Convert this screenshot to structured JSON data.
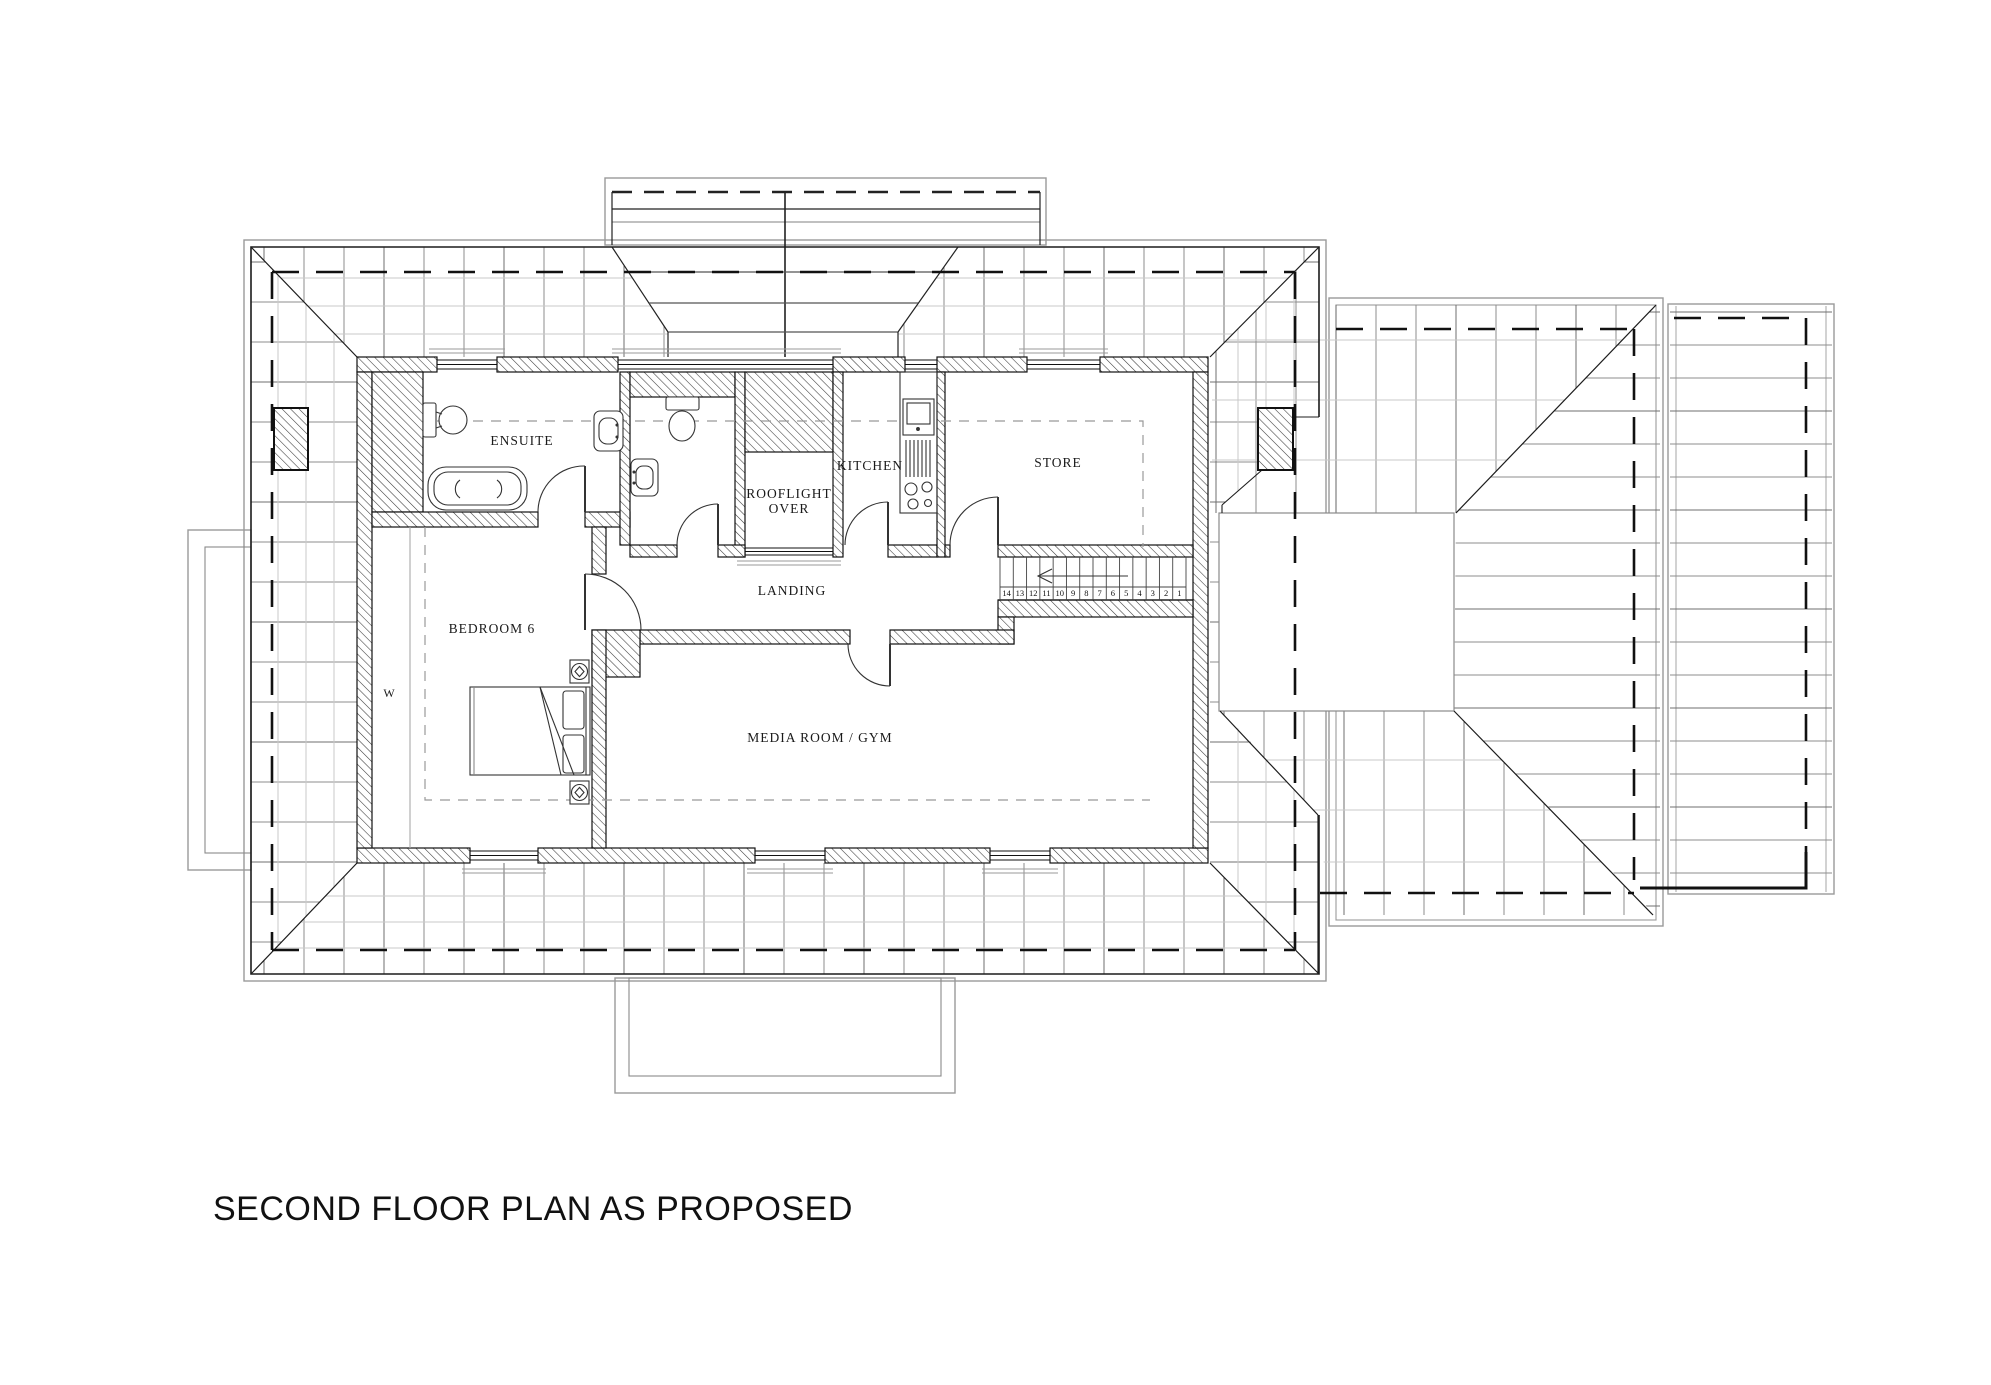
{
  "drawing_title": "SECOND FLOOR PLAN AS PROPOSED",
  "rooms": {
    "ensuite": "ENSUITE",
    "wardrobe": "W",
    "bedroom": "BEDROOM 6",
    "rooflight_line1": "ROOFLIGHT",
    "rooflight_line2": "OVER",
    "kitchen": "KITCHEN",
    "store": "STORE",
    "landing": "LANDING",
    "media": "MEDIA ROOM / GYM"
  },
  "stairs": {
    "treads": [
      "14",
      "13",
      "12",
      "11",
      "10",
      "9",
      "8",
      "7",
      "6",
      "5",
      "4",
      "3",
      "2",
      "1"
    ]
  },
  "colors": {
    "ink": "#1c1c1c",
    "wall_line": "#111111",
    "roof_gray": "#9a9a9a",
    "tile_dark": "#6f6f6f",
    "tile_mid": "#8d8d8d",
    "tile_faint": "#c9c9c9"
  }
}
